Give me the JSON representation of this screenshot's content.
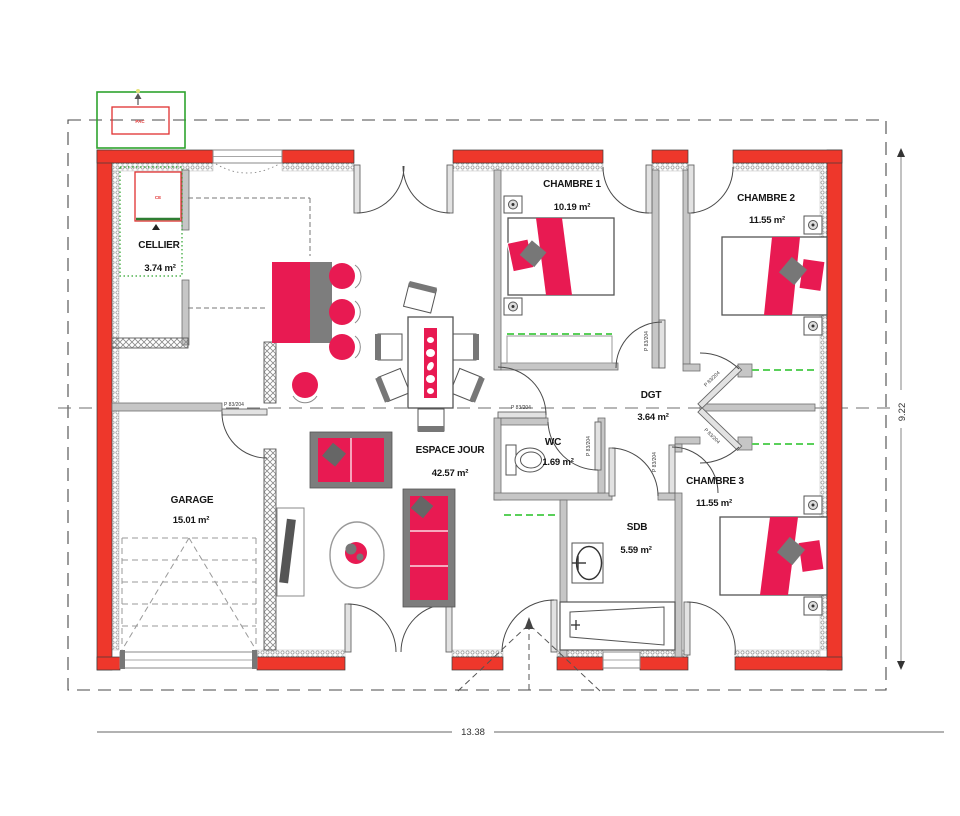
{
  "plan": {
    "type": "single-storey house floor plan",
    "rooms": [
      {
        "id": "cellier",
        "name": "CELLIER",
        "area": "3.74 m²"
      },
      {
        "id": "garage",
        "name": "GARAGE",
        "area": "15.01 m²"
      },
      {
        "id": "espace-jour",
        "name": "ESPACE JOUR",
        "area": "42.57 m²"
      },
      {
        "id": "chambre1",
        "name": "CHAMBRE 1",
        "area": "10.19 m²"
      },
      {
        "id": "chambre2",
        "name": "CHAMBRE 2",
        "area": "11.55 m²"
      },
      {
        "id": "chambre3",
        "name": "CHAMBRE 3",
        "area": "11.55 m²"
      },
      {
        "id": "dgt",
        "name": "DGT",
        "area": "3.64 m²"
      },
      {
        "id": "wc",
        "name": "WC",
        "area": "1.69 m²"
      },
      {
        "id": "sdb",
        "name": "SDB",
        "area": "5.59 m²"
      }
    ],
    "labels": {
      "door_size": "P 83/204"
    },
    "dimensions": {
      "width_m": "13.38",
      "height_m": "9.22"
    },
    "equipment": {
      "outdoor_unit": "PAC",
      "water_heater": "CE"
    },
    "colors": {
      "wall_red": "#ee372b",
      "furniture_red": "#e81a52",
      "interior_wall_grey": "#c6c6c6",
      "green_outline": "#2ea32e",
      "closet_dash_green": "#5ad05a"
    }
  }
}
